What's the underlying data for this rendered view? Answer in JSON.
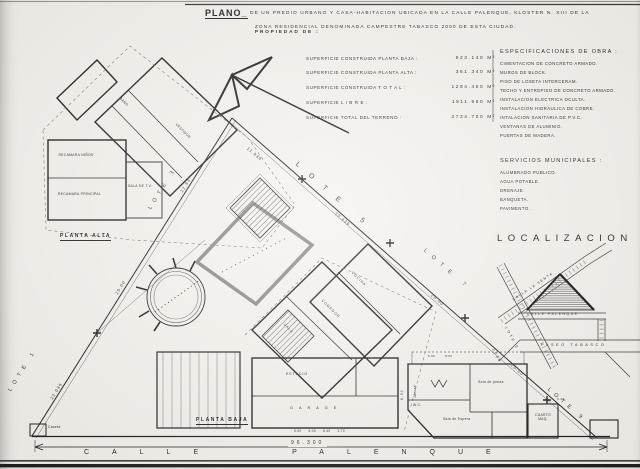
{
  "header": {
    "plano": "PLANO_",
    "line1": "DE UN PREDIO URBANO Y CASA-HABITACION UBICADA EN LA CALLE PALENQUE, KLOSTER N. XIII DE LA",
    "line2": "ZONA RESIDENCIAL DENOMINADA CAMPESTRE TABASCO 2000 DE ESTA CIUDAD.",
    "line2_bold": "PROPIEDAD DE :"
  },
  "superficies": {
    "rows": [
      {
        "label": "SUPERFICIE CONSTRUIDA PLANTA BAJA :",
        "value": "923.140 M²"
      },
      {
        "label": "SUPERFICIE CONSTRUIDA PLANTA ALTA :",
        "value": "361.340 M²"
      },
      {
        "label": "SUPERFICIE CONSTRUIDA T O T A L :",
        "value": "1284.480 M²"
      },
      {
        "label": "SUPERFICIE L I B R E :",
        "value": "1811.560 M²"
      },
      {
        "label": "SUPERFICIE TOTAL DEL TERRENO :",
        "value": "2734.700 M²"
      }
    ]
  },
  "especificaciones": {
    "title": "ESPECIFICACIONES DE OBRA :",
    "items": [
      "CIMENTACION DE CONCRETO ARMADO.",
      "MUROS DE BLOCK.",
      "PISO DE LOSETA INTERCERAM.",
      "TECHO Y ENTREPISO DE CONCRETO ARMADO.",
      "INSTALACION ELECTRICA OCULTA.",
      "INSTALACION HIDRAULICA DE COBRE.",
      "INTALACION SANITARIA DE P.V.C.",
      "VENTANAS DE ALUMINIO.",
      "PUERTAS DE MADERA."
    ]
  },
  "servicios": {
    "title": "SERVICIOS MUNICIPALES :",
    "items": [
      "ALUMBRADO PUBLICO.",
      "AGUA POTABLE.",
      "DRENAJE.",
      "BANQUETA.",
      "PAVIMENTO."
    ]
  },
  "localizacion": {
    "title": "LOCALIZACION",
    "calle_venta": "CALLE LA VENTA",
    "calle_palenque": "CALLE PALENQUE",
    "paseo_tabasco": "PASEO TABASCO",
    "lote_8": "LOTE 8",
    "dos_mil": "2000"
  },
  "sitio": {
    "lotes": {
      "lote1": "LOTE 1",
      "lote3": "LOTE 3",
      "lote5": "LOTE 5",
      "lote7": "LOTE 7",
      "lote9": "LOTE 9"
    },
    "dims": {
      "left_lower": "22.036",
      "left_mid": "20.00",
      "left_upper": "22.93",
      "hyp_1": "11.936",
      "hyp_2": "15.436",
      "hyp_3": "20.00",
      "hyp_4": "20.00",
      "base": "96.300",
      "lateral": "8.90",
      "baja_bottom": "5.00      5.00      8.40      3.70",
      "detalle_top": "5.90         8.50",
      "maq": "3.40"
    },
    "calle": "CALLE PALENQUE",
    "caseta": "Caseta"
  },
  "planta_alta": {
    "caption": "PLANTA ALTA",
    "rooms": [
      "RECAMARA NIÑOS",
      "RECAMARA PRINCIPAL",
      "SALA DE T.V.",
      "VESTIDOR",
      "BAÑO"
    ]
  },
  "planta_baja": {
    "caption": "PLANTA BAJA",
    "rooms": [
      "COCINA",
      "COMEDOR",
      "SALA",
      "ESTUDIO",
      "GARAGE"
    ]
  },
  "detalle": {
    "rooms": [
      "Sala de juntas",
      "Sala de Espera",
      "W.C.",
      "Jacuzzi"
    ],
    "cuarto_maq": "CUARTO MAQ."
  }
}
